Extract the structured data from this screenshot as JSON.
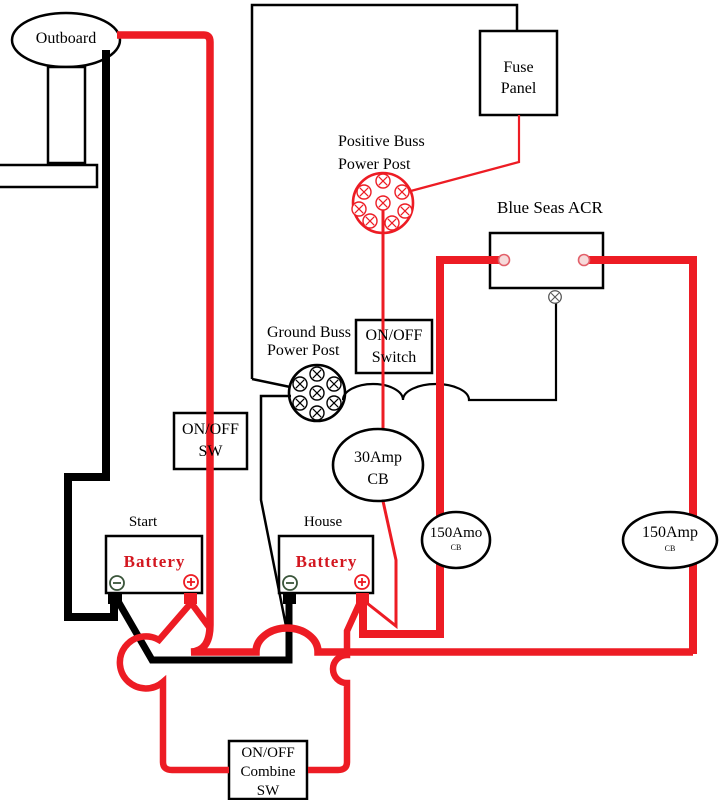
{
  "diagram_title": "Outboard dual battery wiring diagram",
  "colors": {
    "wire_red": "#ED1C24",
    "wire_black": "#000000",
    "battery_label_red": "#D31720",
    "background": "#FFFFFF"
  },
  "components": {
    "outboard": {
      "label": "Outboard"
    },
    "fuse_panel": {
      "line1": "Fuse",
      "line2": "Panel"
    },
    "positive_buss": {
      "line1": "Positive Buss",
      "line2": "Power Post"
    },
    "acr": {
      "label": "Blue Seas ACR"
    },
    "ground_buss": {
      "line1": "Ground Buss",
      "line2": "Power Post"
    },
    "on_off_switch": {
      "line1": "ON/OFF",
      "line2": "Switch"
    },
    "on_off_sw": {
      "line1": "ON/OFF",
      "line2": "SW"
    },
    "cb_30amp": {
      "line1": "30Amp",
      "line2": "CB"
    },
    "start_battery": {
      "group": "Start",
      "label": "Battery",
      "minus": "−",
      "plus": "+"
    },
    "house_battery": {
      "group": "House",
      "label": "Battery",
      "minus": "−",
      "plus": "+"
    },
    "cb_150_left": {
      "label": "150Amo",
      "sub": "CB"
    },
    "cb_150_right": {
      "label": "150Amp",
      "sub": "CB"
    },
    "combine_sw": {
      "line1": "ON/OFF",
      "line2": "Combine",
      "line3": "SW"
    }
  }
}
